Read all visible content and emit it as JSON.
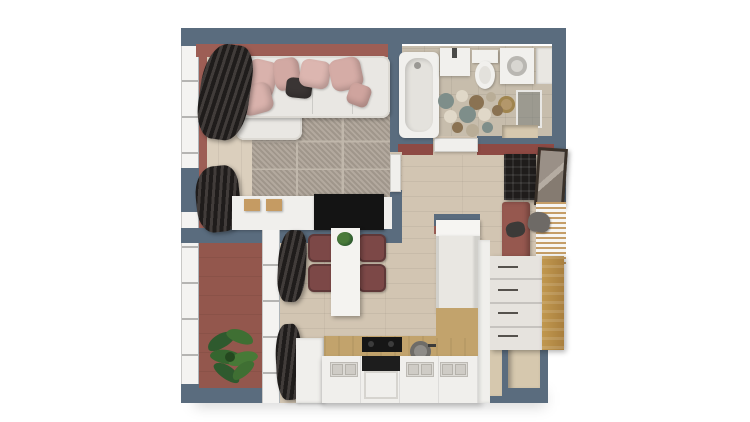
{
  "canvas": {
    "width": 750,
    "height": 422,
    "background": "#ffffff"
  },
  "scene": {
    "type": "3d-floor-plan-render",
    "description": "Top-down 3D render of a small apartment floor plan with living room, bathroom, hallway, kitchen-dining room and balcony",
    "no_visible_text": true
  },
  "palette": {
    "outer_wall_slate": "#5a6c7e",
    "accent_wall_terracotta": "#9d5e55",
    "red_wall_band": "#8e4a44",
    "living_floor_wood": "#dbcfbd",
    "hall_kitchen_floor_wood": "#d2c5b2",
    "bathroom_floor_stone": "#c7bdac",
    "balcony_floor_terracotta": "#93574d",
    "sofa_white": "#e9e7e3",
    "pillow_blush": "#d9b2ac",
    "pillow_dark": "#3a3534",
    "rug_gray": "#ada397",
    "curtain_dark": "#2a2624",
    "tv_black": "#141414",
    "chair_maroon": "#7c4847",
    "counter_wood": "#c2a36c",
    "dresser_wood": "#c1984f",
    "plant_green": "#3f6f33",
    "mosaic_teal": "#7e8e8a",
    "mosaic_brown": "#8a7252",
    "mosaic_cream": "#e0d8c8",
    "doormat_red": "#a04f43",
    "niche_beige": "#d6c8ae"
  },
  "rooms": [
    {
      "name": "living-room",
      "floor": "light oak planks",
      "items": [
        "left-windows",
        "dark-curtains",
        "terracotta-accent-wall",
        "corner-sofa",
        "blush-pillows",
        "dark-pillow",
        "gray-area-rug",
        "white-sideboard",
        "wood-storage-boxes",
        "tv"
      ]
    },
    {
      "name": "bathroom",
      "floor": "stone tiles",
      "items": [
        "bathtub",
        "washbasin",
        "toilet",
        "washing-machine",
        "side-cabinet",
        "mosaic-dot-rug",
        "shower-screen",
        "laundry-basket",
        "wall-shelf-niche",
        "open-door"
      ]
    },
    {
      "name": "hallway",
      "floor": "oak planks",
      "items": [
        "shoe-cabinet",
        "leaning-mirror",
        "entry-bench",
        "hanging-jacket",
        "slatted-coat-rack",
        "wood-dresser",
        "red-doormat",
        "wall-niches"
      ]
    },
    {
      "name": "kitchen-dining",
      "floor": "oak planks",
      "items": [
        "dining-table",
        "table-plant",
        "four-maroon-chairs",
        "counter-run",
        "cooktop",
        "oven",
        "round-sink",
        "tall-open-cabinet",
        "white-bench",
        "base-cabinet-grilles",
        "balcony-glazing",
        "dark-curtains"
      ]
    },
    {
      "name": "balcony",
      "floor": "terracotta tiles",
      "items": [
        "potted-plant",
        "full-height-windows"
      ]
    }
  ]
}
